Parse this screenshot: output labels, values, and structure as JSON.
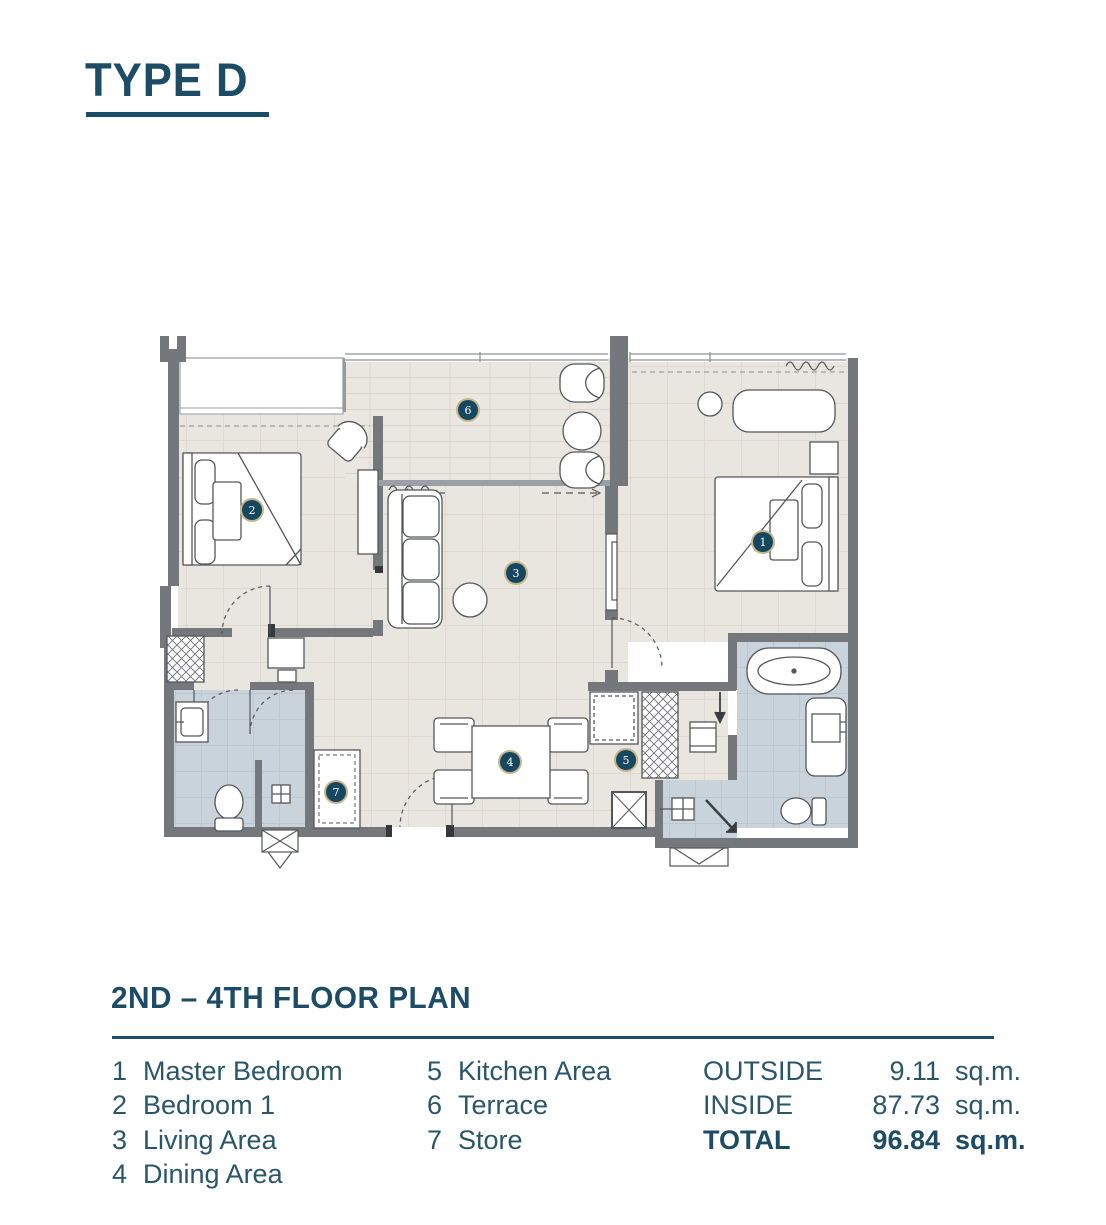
{
  "title": "TYPE D",
  "section": {
    "heading": "2ND – 4TH FLOOR PLAN"
  },
  "legend": {
    "rooms": [
      {
        "num": "1",
        "label": "Master Bedroom"
      },
      {
        "num": "2",
        "label": "Bedroom 1"
      },
      {
        "num": "3",
        "label": "Living Area"
      },
      {
        "num": "4",
        "label": "Dining Area"
      },
      {
        "num": "5",
        "label": "Kitchen Area"
      },
      {
        "num": "6",
        "label": "Terrace"
      },
      {
        "num": "7",
        "label": "Store"
      }
    ],
    "areas": [
      {
        "label": "OUTSIDE",
        "value": "9.11",
        "unit": "sq.m.",
        "bold": false
      },
      {
        "label": "INSIDE",
        "value": "87.73",
        "unit": "sq.m.",
        "bold": false
      },
      {
        "label": "TOTAL",
        "value": "96.84",
        "unit": "sq.m.",
        "bold": true
      }
    ]
  },
  "plan": {
    "room_markers": [
      {
        "num": "1",
        "x": 613,
        "y": 212
      },
      {
        "num": "2",
        "x": 102,
        "y": 180
      },
      {
        "num": "3",
        "x": 366,
        "y": 243
      },
      {
        "num": "4",
        "x": 360,
        "y": 432
      },
      {
        "num": "5",
        "x": 476,
        "y": 430
      },
      {
        "num": "6",
        "x": 318,
        "y": 80
      },
      {
        "num": "7",
        "x": 186,
        "y": 462
      }
    ]
  },
  "colors": {
    "accent_teal": "#1c4c66",
    "legend_text": "#29566a",
    "wall_gray": "#74777c",
    "floor_beige": "#e9e6e0",
    "bath_blue": "#c9d3dc",
    "badge_navy": "#15485f",
    "badge_ring": "#c6b68c"
  }
}
